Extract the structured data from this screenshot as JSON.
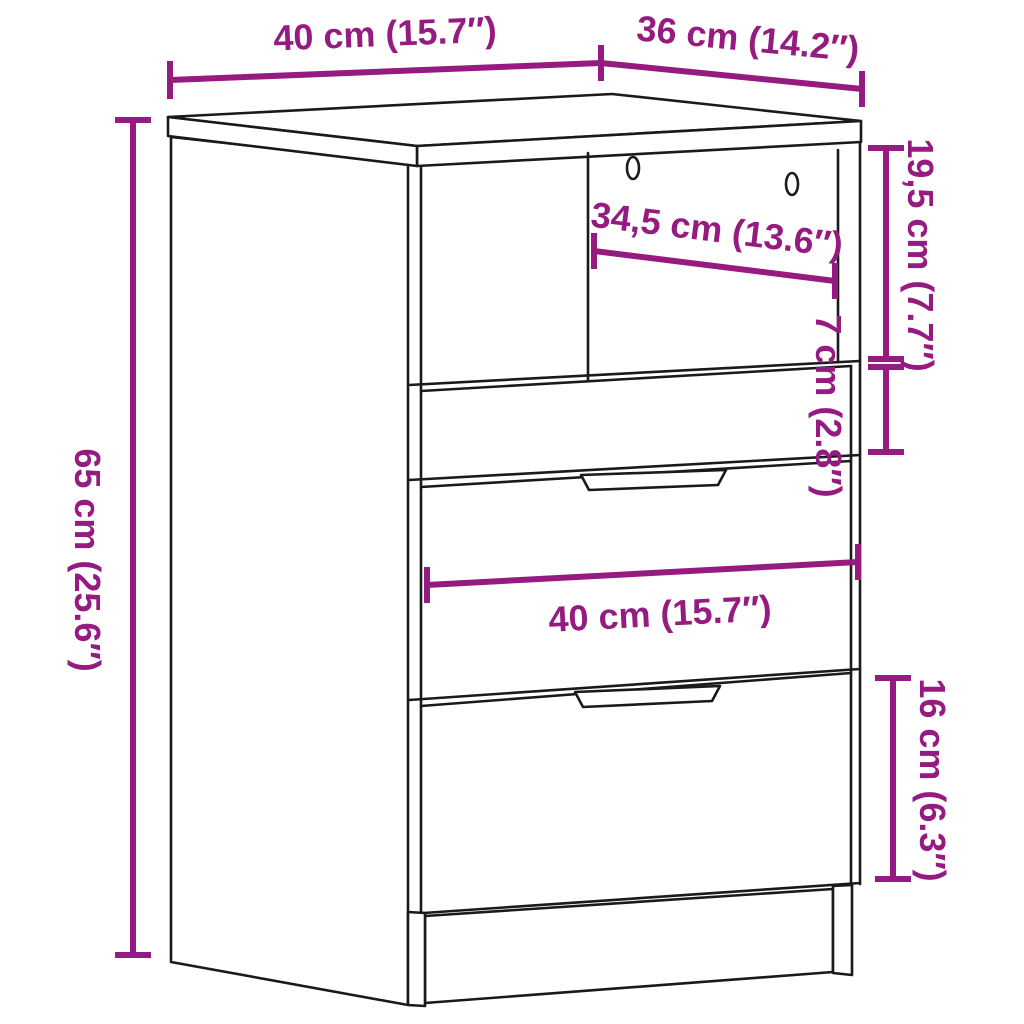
{
  "diagram": {
    "subject": "bedside-cabinet-with-3-drawers-dimension-diagram",
    "colors": {
      "accent": "#951b81",
      "line": "#1a1a1a",
      "background": "#ffffff"
    },
    "dimensions": {
      "top_width": {
        "cm": "40 cm",
        "inch": "15.7″",
        "label": "40 cm (15.7″)"
      },
      "top_depth": {
        "cm": "36 cm",
        "inch": "14.2″",
        "label": "36 cm (14.2″)"
      },
      "overall_height": {
        "cm": "65 cm",
        "inch": "25.6″",
        "label": "65 cm (25.6″)"
      },
      "niche_width": {
        "cm": "34,5 cm",
        "inch": "13.6″",
        "label": "34,5 cm (13.6″)"
      },
      "niche_height": {
        "cm": "19,5 cm",
        "inch": "7.7″",
        "label": "19,5 cm (7.7″)"
      },
      "top_drawer_height": {
        "cm": "7 cm",
        "inch": "2.8″",
        "label": "7 cm (2.8″)"
      },
      "drawer_width": {
        "cm": "40 cm",
        "inch": "15.7″",
        "label": "40 cm (15.7″)"
      },
      "bottom_drawer_height": {
        "cm": "16 cm",
        "inch": "6.3″",
        "label": "16 cm (6.3″)"
      }
    }
  }
}
